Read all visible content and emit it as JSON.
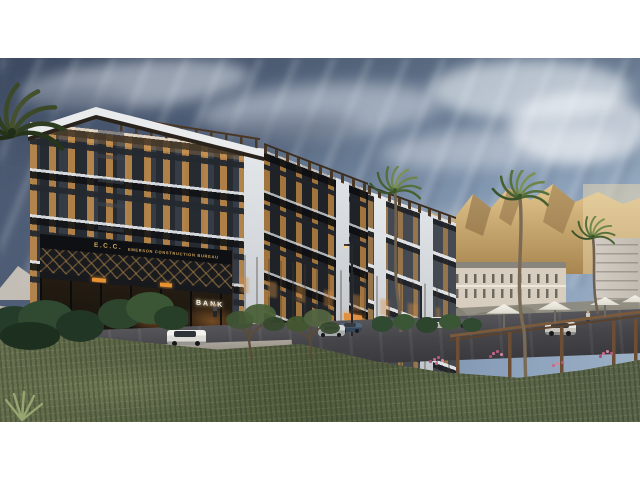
{
  "meta": {
    "kind": "architectural-render-photo",
    "letterbox": "#ffffff",
    "scene": "Dusk exterior rendering of a modern dark-facade residential complex with ground-floor bank branches, palm trees, desert mountains, street with cars and a landscaped plaza with pergola and umbrellas"
  },
  "signs": {
    "logo": "E.C.C.",
    "company_name": "EMERSON CONSTRUCTION BUREAU",
    "bank_left": "BANK",
    "bank_right": "BANK"
  },
  "palette": {
    "sky_dark": "#4a5870",
    "sky_light": "#9db1c6",
    "cloud": "#e4eaf0",
    "mountain_gold": "#d3b177",
    "mountain_shadow": "#8a6a42",
    "facade_dark": "#24272d",
    "facade_white": "#e6e9ec",
    "window_glow": "#dd9c4e",
    "sign_gold": "#d2a85c",
    "bank_text": "#f7f3e8",
    "asphalt": "#47474a",
    "sidewalk": "#a39d93",
    "curb_stripe": "#b0492e",
    "grass": "#5c6847",
    "foliage": "#35502f",
    "palm_frond": "#55703a",
    "pergola_wood": "#6b4e34",
    "umbrella": "#efece4",
    "flower_pink": "#c9688c",
    "distant_building": "#d8cec0"
  }
}
